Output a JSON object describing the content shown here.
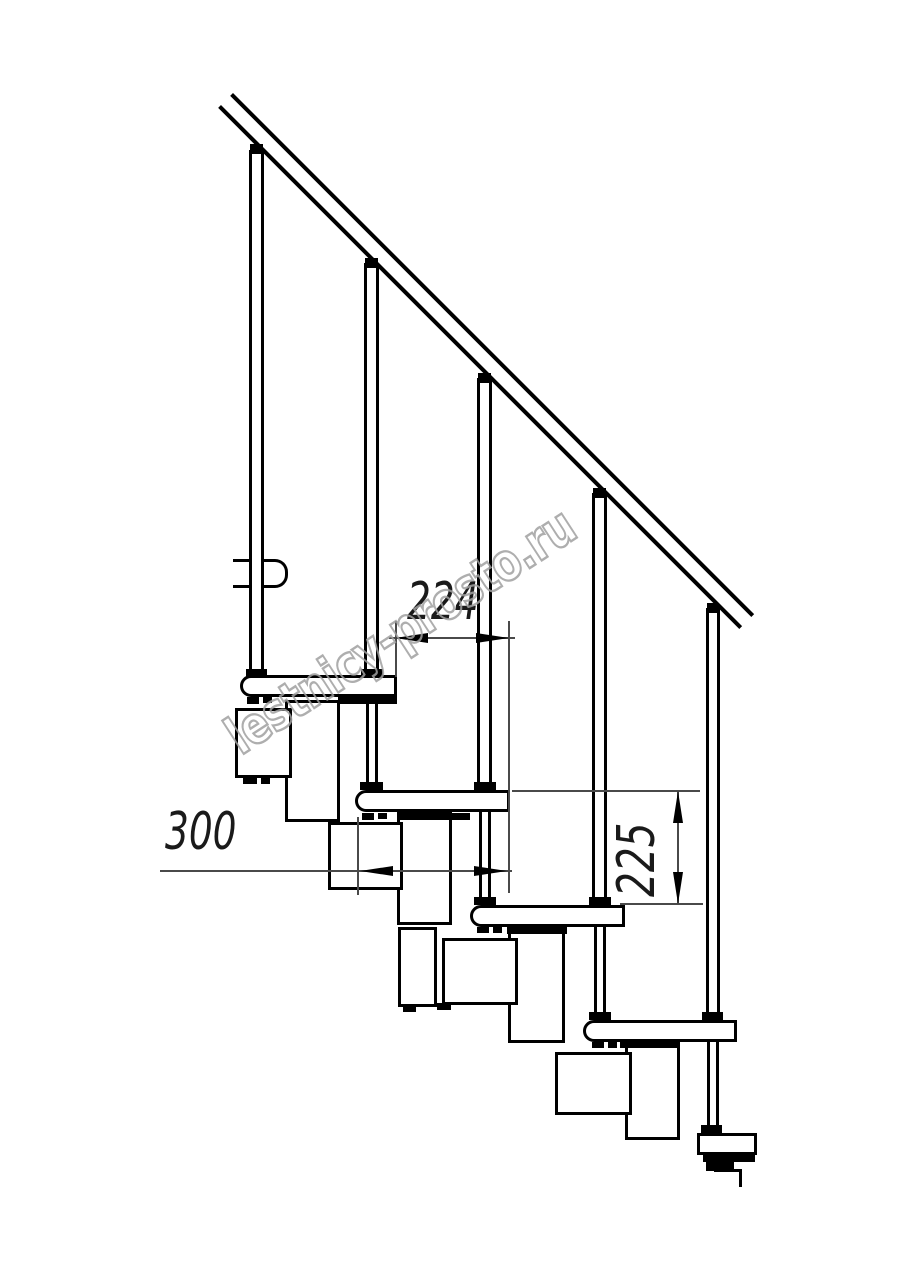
{
  "drawing": {
    "title": "Modular staircase side-view technical drawing",
    "watermark": "lestnicy-prosto.ru",
    "dimensions": {
      "run": "224",
      "tread_depth": "300",
      "rise": "225"
    },
    "counts": {
      "balusters": 5,
      "treads": 6
    },
    "colors": {
      "line": "#000000",
      "dim_line": "#4a4a4a",
      "watermark": "#a0a0a0",
      "background": "#ffffff"
    }
  }
}
